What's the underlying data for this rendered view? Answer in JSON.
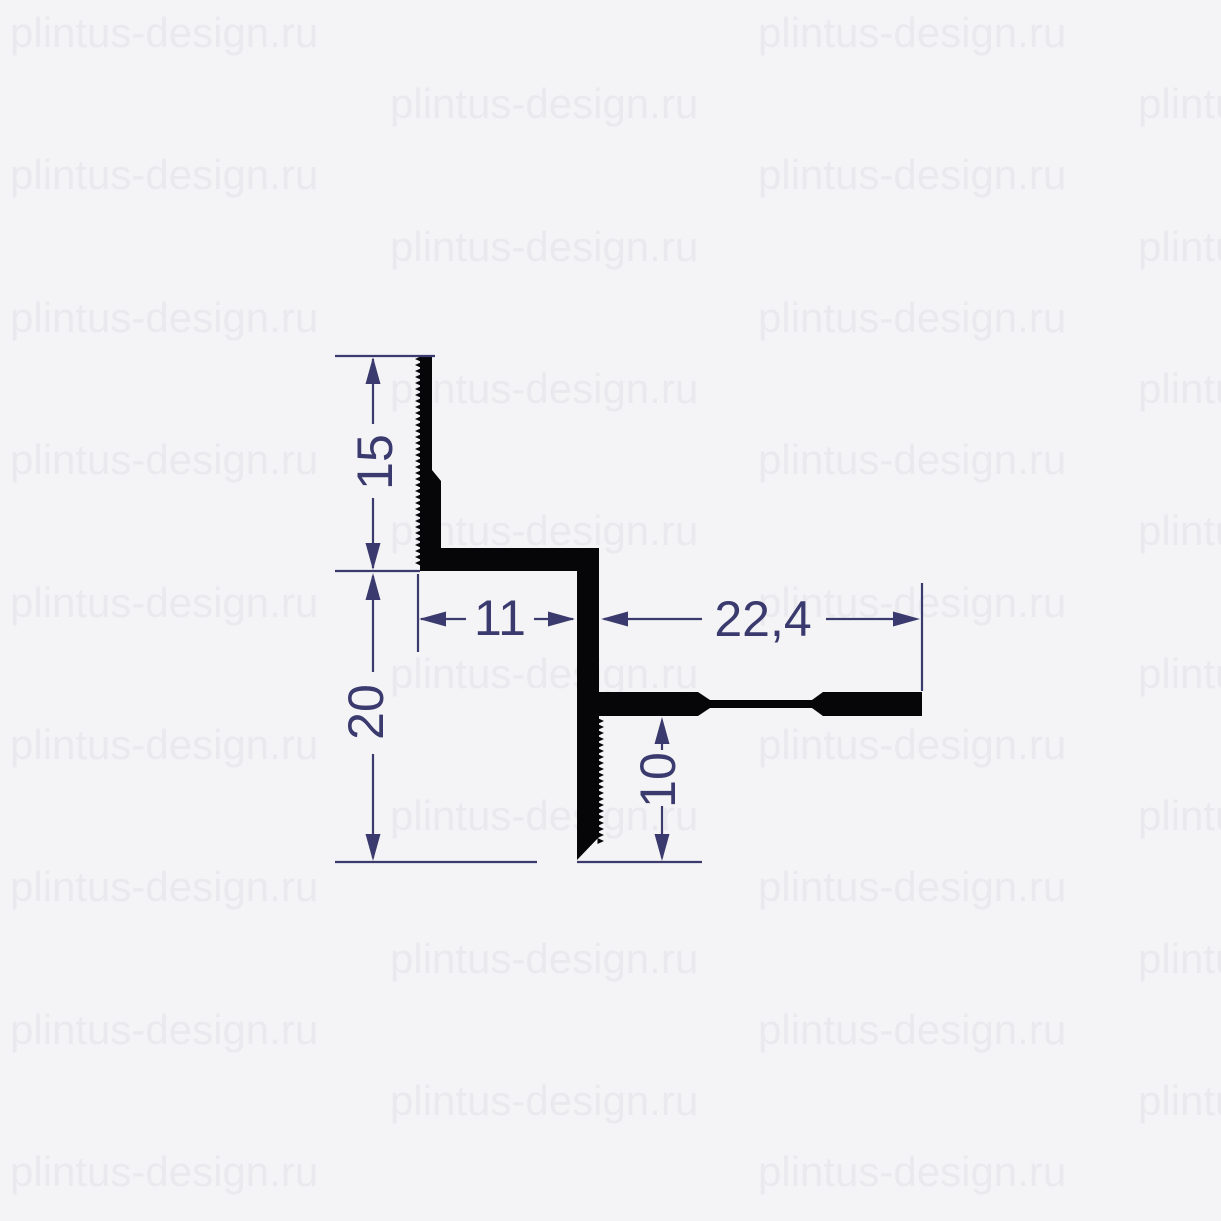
{
  "watermark": {
    "text": "plintus-design.ru"
  },
  "colors": {
    "background": "#f4f4f6",
    "watermark": "#eaeaee",
    "profile": "#060608",
    "dimension": "#3a3a6e"
  },
  "dimensions": {
    "height_top": {
      "label": "15"
    },
    "height_bottom": {
      "label": "20"
    },
    "width_step": {
      "label": "11"
    },
    "width_arm": {
      "label": "22,4"
    },
    "leg_below_arm": {
      "label": "10"
    }
  }
}
